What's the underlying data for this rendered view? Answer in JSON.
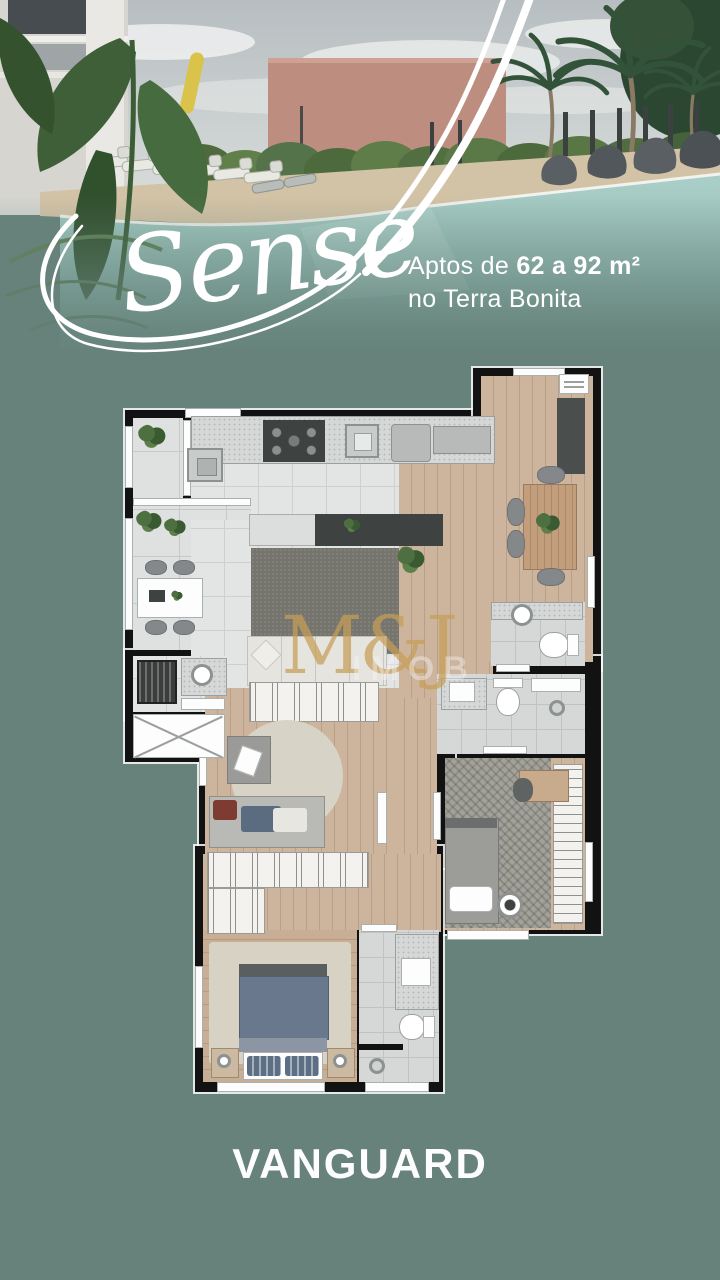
{
  "hero": {
    "brand": "Sense",
    "tagline": {
      "prefix": "Aptos de ",
      "range": "62 a 92 m²",
      "line2": "no Terra Bonita"
    }
  },
  "watermark": {
    "brand": "M&J",
    "suffix": "IMOB"
  },
  "footer": {
    "logo": "VANGUARD"
  },
  "palette": {
    "background": "#66827A",
    "pool": "#9CC5BD",
    "accent_wall": "#BD8E7F",
    "plan_wall": "#121212",
    "plan_tile": "#E3E5E4",
    "plan_wood": "#CDB49D",
    "watermark_gold": "#C79E58",
    "text": "#FFFFFF"
  }
}
